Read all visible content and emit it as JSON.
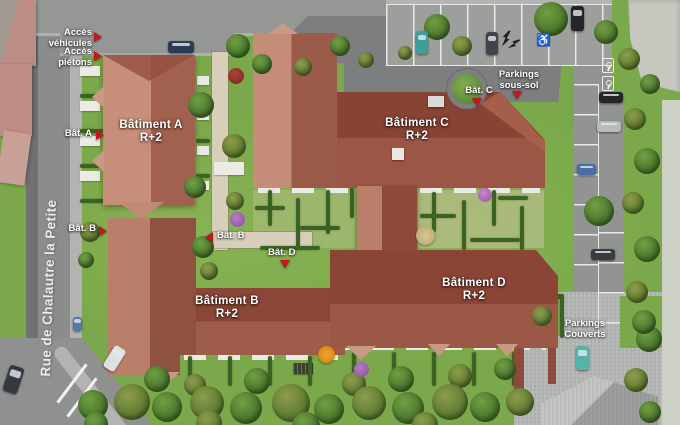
{
  "scene": {
    "street_name": "Rue de Chalautre la Petite"
  },
  "buildings": [
    {
      "key": "a",
      "name": "Bâtiment A",
      "floors": "R+2"
    },
    {
      "key": "b",
      "name": "Bâtiment B",
      "floors": "R+2"
    },
    {
      "key": "c",
      "name": "Bâtiment C",
      "floors": "R+2"
    },
    {
      "key": "d",
      "name": "Bâtiment D",
      "floors": "R+2"
    }
  ],
  "callouts": {
    "acces_vehicules": {
      "line1": "Accès",
      "line2": "véhicules"
    },
    "acces_pietons": {
      "line1": "Accès",
      "line2": "piétons"
    },
    "bat_a": "Bât. A",
    "bat_b_street": "Bât. B",
    "bat_b_inner": "Bât. B",
    "bat_c": "Bât. C",
    "bat_d_inner": "Bât. D",
    "parkings_sous_sol": {
      "line1": "Parkings",
      "line2": "sous-sol"
    },
    "parkings_couverts": {
      "line1": "Parkings",
      "line2": "Couverts"
    }
  },
  "icons": {
    "wheelchair": "♿"
  },
  "colors": {
    "marker_red": "#c4161d",
    "roof_dark": "#8d4a3b",
    "roof_light": "#c78e7a",
    "lawn_green": "#7aa84a",
    "road_grey": "#8f9190"
  }
}
